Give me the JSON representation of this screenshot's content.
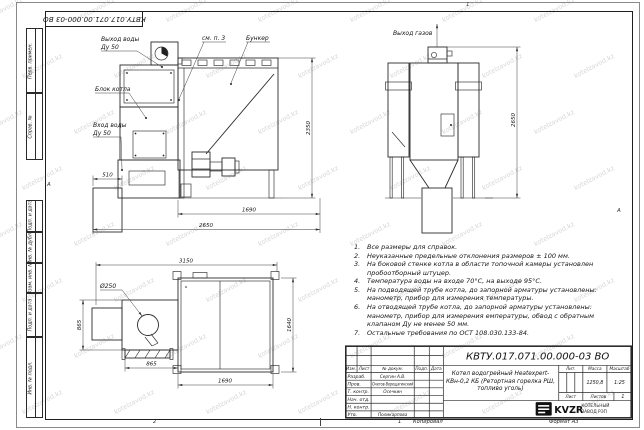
{
  "doc_number": "КВТУ.017.071.00.000-03 ВО",
  "zones": {
    "top": "1",
    "bottom": "2",
    "bottom_num": "1",
    "left": "А",
    "right": "А"
  },
  "margin_labels": [
    "Перв. примен.",
    "Справ. №",
    "Подп. и дата",
    "Инв. № дубл.",
    "Взам. инв. №",
    "Подп. и дата",
    "Инв. № подл."
  ],
  "views": {
    "side": {
      "water_outlet_label": "Выход воды",
      "water_outlet_dn": "Ду 50",
      "boiler_block_label": "Блок котла",
      "water_inlet_label": "Вход воды",
      "water_inlet_dn": "Ду 50",
      "see_note_label": "см. п. 3",
      "hopper_label": "Бункер",
      "dim_height": "2350",
      "dim_ash": "510",
      "dim_hopper": "1690",
      "dim_total": "2650"
    },
    "rear": {
      "gas_outlet_label": "Выход газов",
      "dim_height": "2650"
    },
    "plan": {
      "dia_label": "Ø250",
      "dim_total": "3150",
      "dim_left_depth": "865",
      "dim_left_width": "865",
      "dim_hopper_width": "1690",
      "dim_hopper_depth": "1640"
    }
  },
  "notes": [
    {
      "num": "1.",
      "text": "Все размеры для справок."
    },
    {
      "num": "2.",
      "text": "Неуказанные предельные отклонения размеров ± 100 мм."
    },
    {
      "num": "3.",
      "text": "На боковой стенке котла в области топочной камеры установлен пробоотборный штуцер."
    },
    {
      "num": "4.",
      "text": "Температура воды на входе 70°С, на выходе 95°С."
    },
    {
      "num": "5.",
      "text": "На подводящей трубе котла, до запорной арматуры установлены: манометр, прибор для измерения температуры."
    },
    {
      "num": "6.",
      "text": "На отводящей трубе котла, до запорной арматуры установлены: манометр, прибор для измерения емпературы, обвод с обратным клапаном Ду не менее 50 мм."
    },
    {
      "num": "7.",
      "text": "Остальные требования по ОСТ 108.030.133-84."
    }
  ],
  "title_block": {
    "header": {
      "izm": "Изм.",
      "list": "Лист",
      "doc": "№ докум.",
      "sign": "Подп.",
      "date": "Дата"
    },
    "rows": [
      {
        "role": "Разраб.",
        "name": "Сергин А.В."
      },
      {
        "role": "Пров.",
        "name": "Онегов-Верещагинский"
      },
      {
        "role": "Т. контр.",
        "name": "Осечкин"
      },
      {
        "role": "Нач. отд.",
        "name": ""
      },
      {
        "role": "Н. контр.",
        "name": ""
      },
      {
        "role": "Утв.",
        "name": "Поликарпова"
      }
    ],
    "product_title": "Котел водогрейный Heatexpert-КВн-0,2 КБ (Ретортная горелка РШ, топливо уголь)",
    "lit_label": "Лит.",
    "mass_label": "Масса",
    "scale_label": "Масштаб",
    "mass": "1250,8",
    "scale": "1:25",
    "sheet_label": "Лист",
    "sheets_label": "Листов",
    "sheets": "1",
    "logo_text": "KVZR",
    "logo_caption_1": "КОТЕЛЬНЫЙ",
    "logo_caption_2": "ЗАВОД РЭП"
  },
  "footer": {
    "copied": "Копировал",
    "format": "Формат А3"
  },
  "watermark": {
    "text": "kotelzavod.kz"
  }
}
